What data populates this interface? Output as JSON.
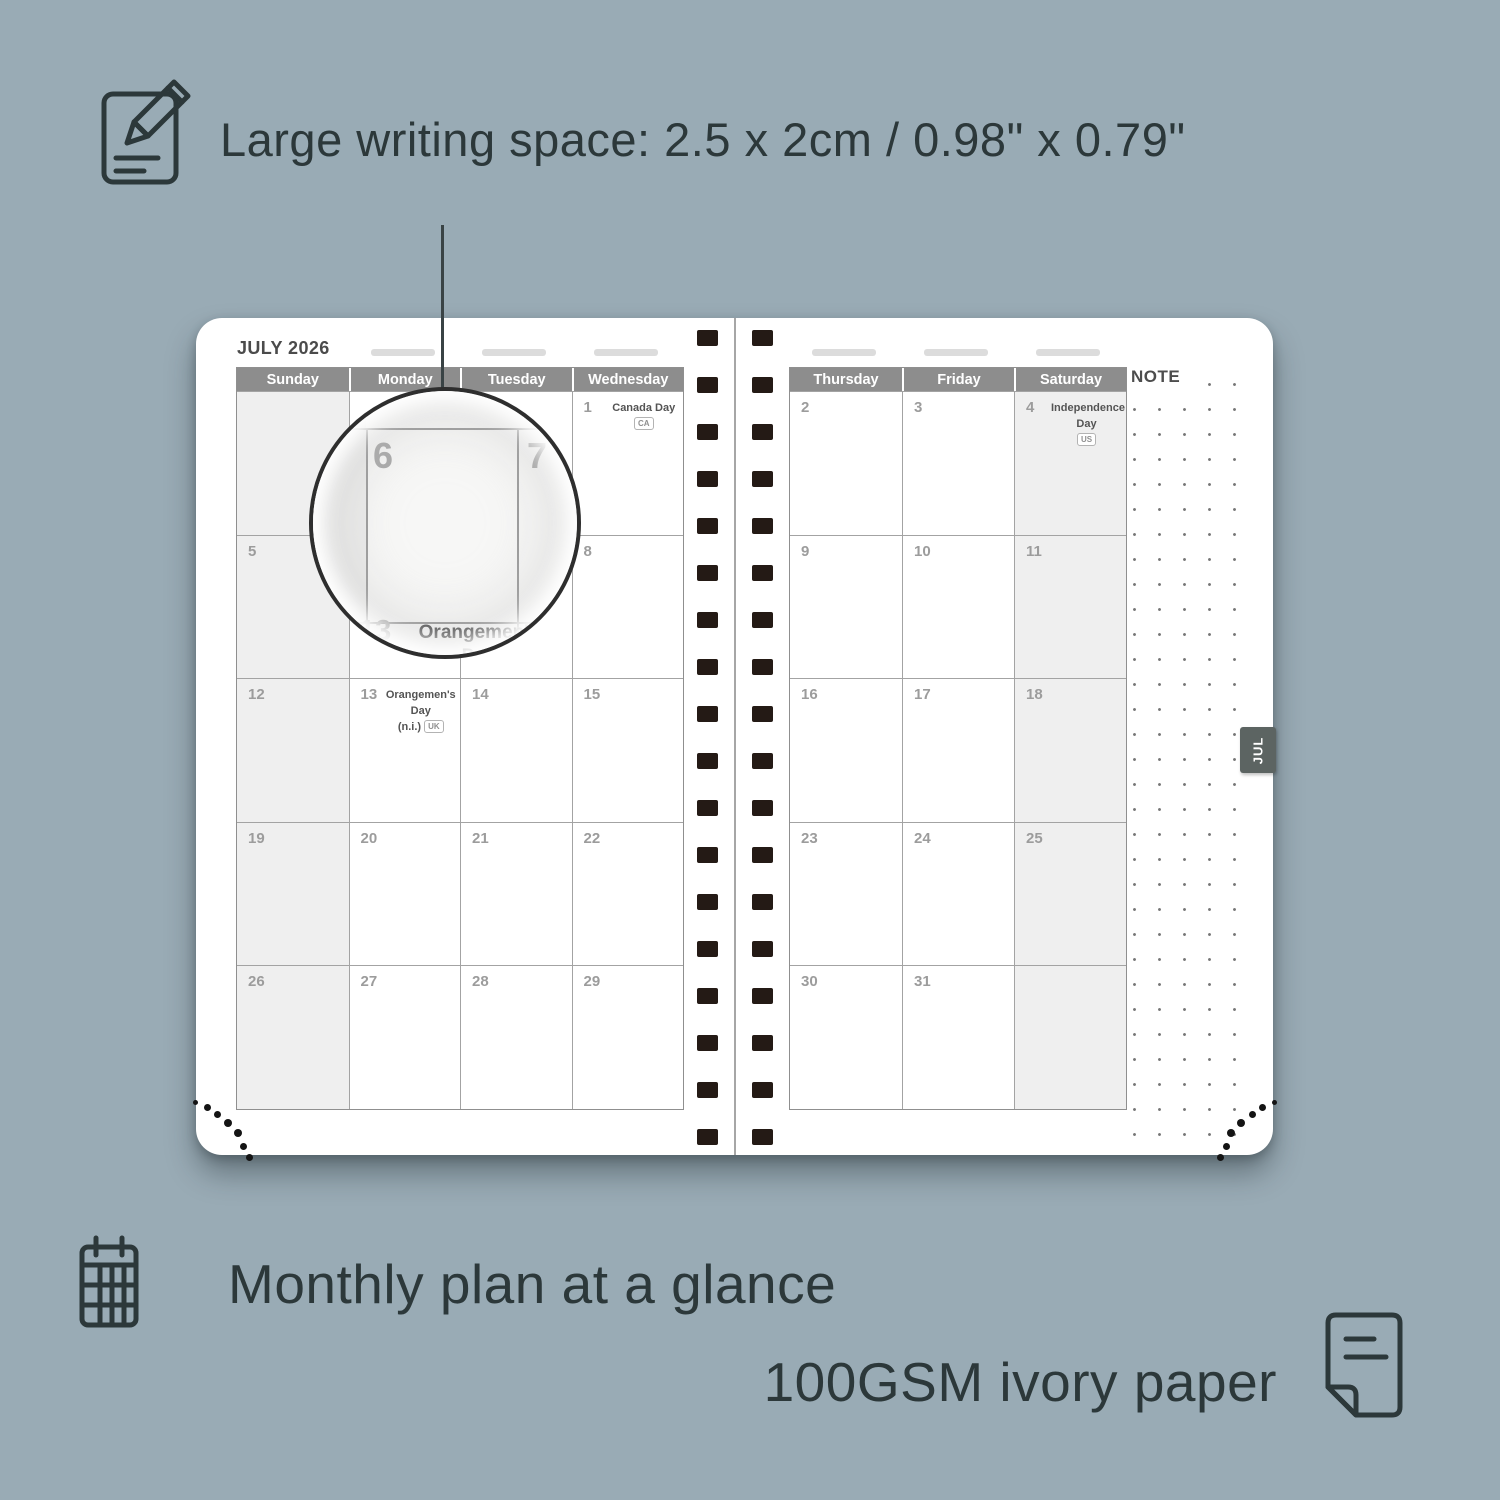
{
  "features": {
    "writing_space": "Large writing space: 2.5 x 2cm / 0.98\" x 0.79\"",
    "monthly_plan": "Monthly plan at a glance",
    "paper": "100GSM ivory paper"
  },
  "planner": {
    "month_title": "JULY 2026",
    "note_label": "NOTE",
    "tab_label": "JUL",
    "left_page": {
      "day_headers": [
        "Sunday",
        "Monday",
        "Tuesday",
        "Wednesday"
      ],
      "weekend_col": 0,
      "rows": [
        [
          {
            "day": ""
          },
          {
            "day": ""
          },
          {
            "day": ""
          },
          {
            "day": "1",
            "holiday": "Canada Day",
            "badge": "CA",
            "badge_inline": true
          }
        ],
        [
          {
            "day": "5"
          },
          {
            "day": "6"
          },
          {
            "day": "7"
          },
          {
            "day": "8"
          }
        ],
        [
          {
            "day": "12"
          },
          {
            "day": "13",
            "holiday": "Orangemen's Day",
            "holiday2": "(n.i.)",
            "badge": "UK"
          },
          {
            "day": "14"
          },
          {
            "day": "15"
          }
        ],
        [
          {
            "day": "19"
          },
          {
            "day": "20"
          },
          {
            "day": "21"
          },
          {
            "day": "22"
          }
        ],
        [
          {
            "day": "26"
          },
          {
            "day": "27"
          },
          {
            "day": "28"
          },
          {
            "day": "29"
          }
        ]
      ]
    },
    "right_page": {
      "day_headers": [
        "Thursday",
        "Friday",
        "Saturday"
      ],
      "weekend_col": 2,
      "rows": [
        [
          {
            "day": "2"
          },
          {
            "day": "3"
          },
          {
            "day": "4",
            "holiday": "Independence Day",
            "badge": "US"
          }
        ],
        [
          {
            "day": "9"
          },
          {
            "day": "10"
          },
          {
            "day": "11"
          }
        ],
        [
          {
            "day": "16"
          },
          {
            "day": "17"
          },
          {
            "day": "18"
          }
        ],
        [
          {
            "day": "23"
          },
          {
            "day": "24"
          },
          {
            "day": "25"
          }
        ],
        [
          {
            "day": "30"
          },
          {
            "day": "31"
          },
          {
            "day": ""
          }
        ]
      ]
    },
    "magnifier": {
      "day_left": "6",
      "day_right": "7",
      "day_bottom": "13",
      "holiday": "Orangemen's Day",
      "holiday2": "(n.i.)",
      "badge": "UK"
    }
  },
  "colors": {
    "background": "#99abb5",
    "ink": "#2c383a",
    "header_gray": "#8d8d8d",
    "weekend_gray": "#efefef",
    "binding_black": "#241a15",
    "tab_gray": "#5c6462"
  }
}
